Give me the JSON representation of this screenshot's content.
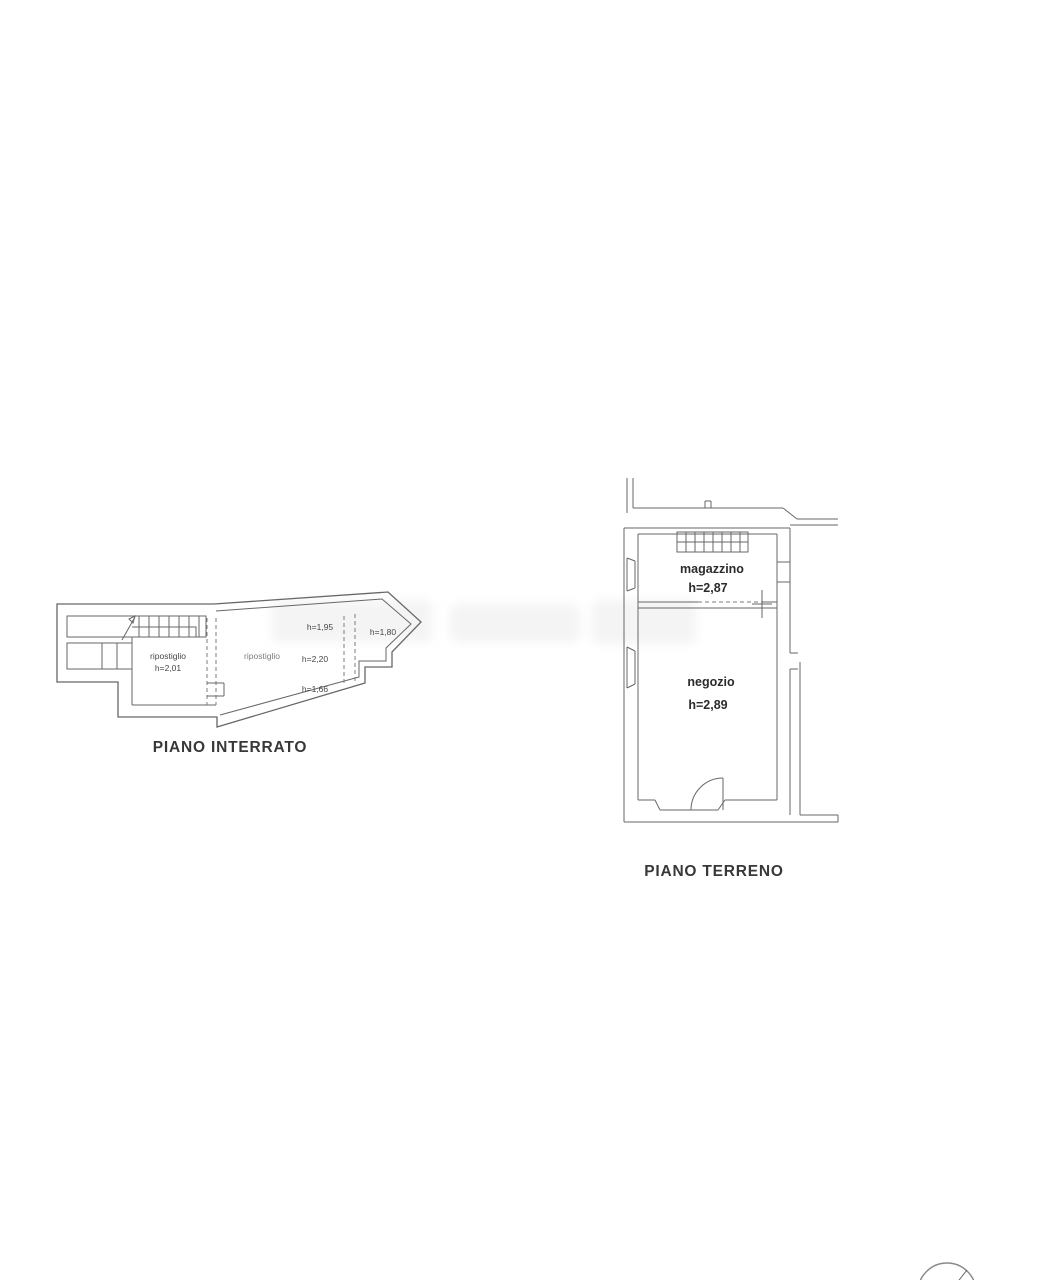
{
  "document": {
    "type": "floor-plan-scan",
    "background": "#ffffff"
  },
  "interrato": {
    "title": "PIANO INTERRATO",
    "room_left": {
      "name": "ripostiglio",
      "height": "h=2,01"
    },
    "room_right": {
      "name": "ripostiglio",
      "height_top": "h=1,95",
      "height_mid": "h=2,20",
      "height_bottom": "h=1,66",
      "height_point": "h=1,80"
    }
  },
  "terreno": {
    "title": "PIANO TERRENO",
    "room_top": {
      "name": "magazzino",
      "height": "h=2,87"
    },
    "room_bottom": {
      "name": "negozio",
      "height": "h=2,89"
    }
  },
  "colors": {
    "wall_line": "#676767",
    "dashed_opening": "#7c7c7c",
    "room_label": "#2b2b2b",
    "title_text": "#383838"
  }
}
